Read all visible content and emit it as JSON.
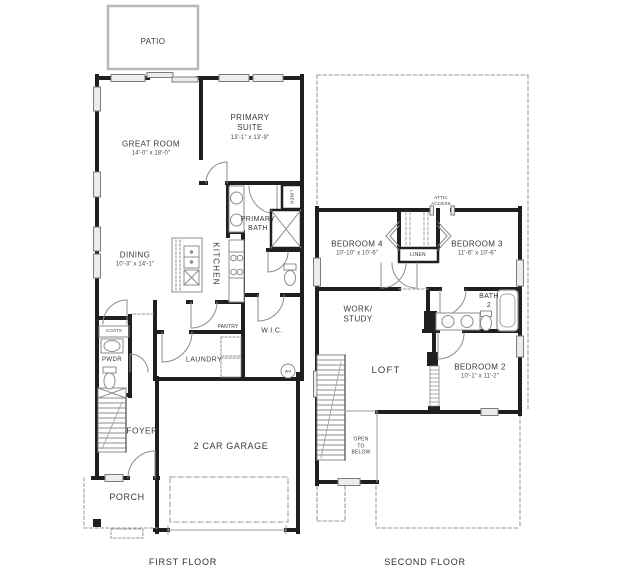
{
  "colors": {
    "wall": "#1f1f1f",
    "thin_line": "#8c8c8c",
    "window_fill": "#ececec",
    "dash": "#9a9a9a",
    "text": "#383838"
  },
  "titles": {
    "first_floor": "FIRST FLOOR",
    "second_floor": "SECOND FLOOR"
  },
  "floors": {
    "first": {
      "rooms": {
        "patio": {
          "name": "PATIO"
        },
        "great_room": {
          "name": "GREAT ROOM",
          "dims": "14'-0\" x 18'-0\""
        },
        "primary_suite": {
          "name": "PRIMARY SUITE",
          "dims": "13'-1\" x 13'-9\""
        },
        "primary_bath": {
          "name": "PRIMARY BATH"
        },
        "kitchen": {
          "name": "KITCHEN"
        },
        "dining": {
          "name": "DINING",
          "dims": "10'-3\" x 14'-1\""
        },
        "pantry": {
          "name": "PANTRY"
        },
        "wic": {
          "name": "W.I.C."
        },
        "laundry": {
          "name": "LAUNDRY"
        },
        "linen": {
          "name": "LINEN"
        },
        "coats": {
          "name": "COATS"
        },
        "powder": {
          "name": "PWDR"
        },
        "foyer": {
          "name": "FOYER"
        },
        "garage": {
          "name": "2 CAR GARAGE"
        },
        "porch": {
          "name": "PORCH"
        },
        "water_heater": {
          "name": "WH"
        }
      }
    },
    "second": {
      "rooms": {
        "attic_access": {
          "name": "ATTIC ACCESS"
        },
        "bedroom4": {
          "name": "BEDROOM 4",
          "dims": "10'-10\" x 10'-6\""
        },
        "bedroom3": {
          "name": "BEDROOM 3",
          "dims": "11'-6\" x 10'-6\""
        },
        "linen": {
          "name": "LINEN"
        },
        "work_study": {
          "name": "WORK/ STUDY"
        },
        "bath2": {
          "name": "BATH 2"
        },
        "loft": {
          "name": "LOFT"
        },
        "bedroom2": {
          "name": "BEDROOM 2",
          "dims": "10'-1\" x 11'-2\""
        },
        "open_to_below": {
          "name": "OPEN TO BELOW"
        }
      }
    }
  }
}
